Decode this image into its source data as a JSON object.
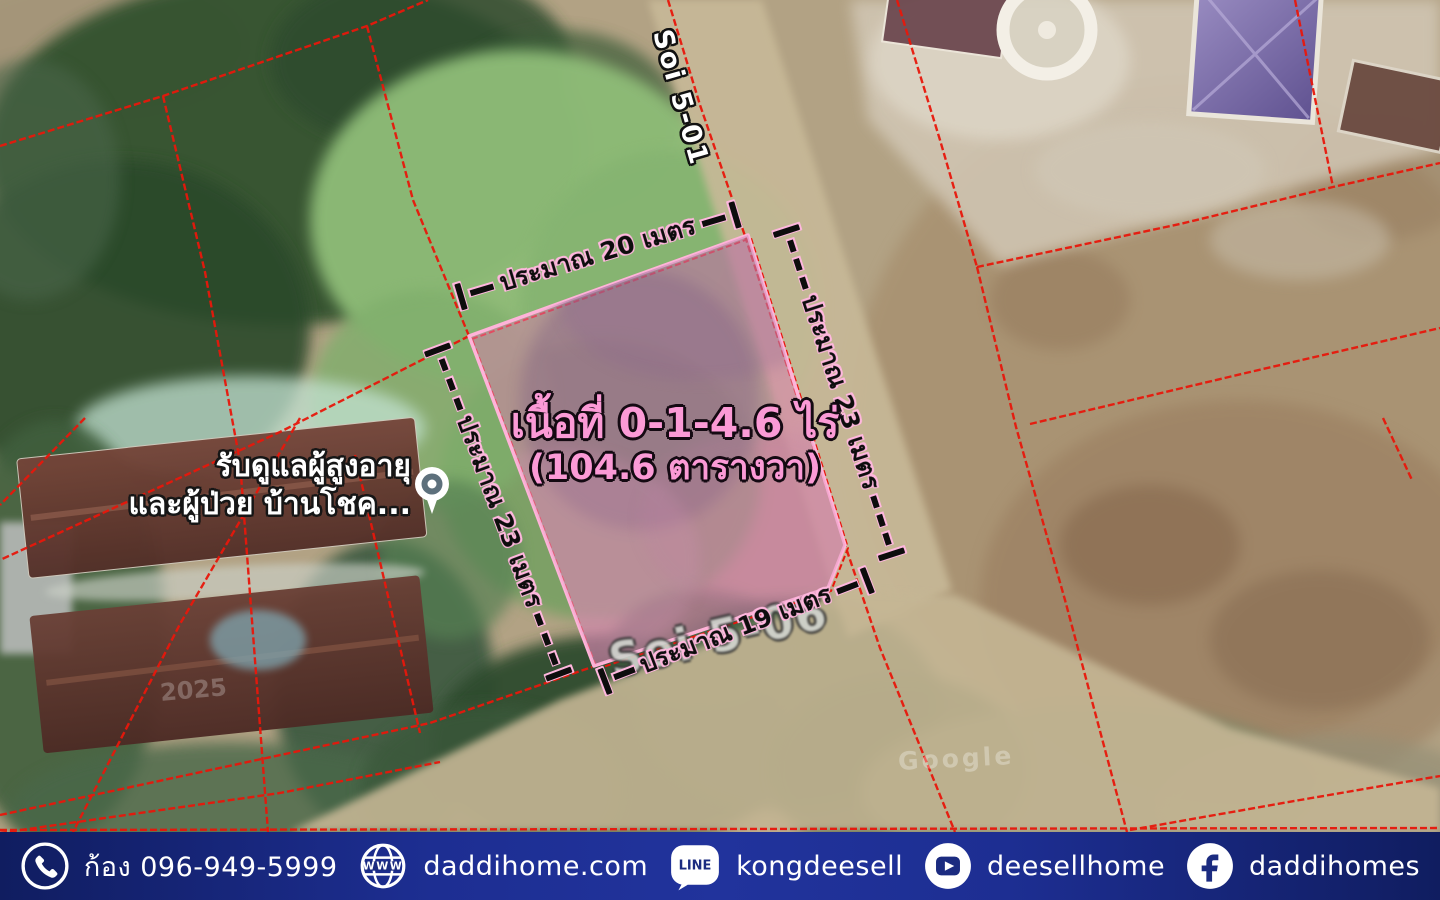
{
  "map": {
    "plot": {
      "area_line1": "เนื้อที่ 0-1-4.6 ไร่",
      "area_line2": "(104.6 ตารางวา)",
      "dimensions": {
        "top": "ประมาณ 20 เมตร",
        "right": "ประมาณ 23 เมตร",
        "left": "ประมาณ 23 เมตร",
        "bottom": "ประมาณ 19 เมตร"
      },
      "fill_color": "#dd7db0",
      "border_color": "#ffb3d9"
    },
    "street_labels": {
      "top": "Soi 5-01",
      "bottom": "Soi 5-06"
    },
    "place_label": {
      "line1": "รับดูแลผู้สูงอายุ",
      "line2": "และผู้ป่วย บ้านโชค..."
    },
    "watermarks": {
      "year": "2025",
      "brand": "Google"
    },
    "cadastral_line_color": "#e8170b"
  },
  "footer": {
    "background_color": "#1d2e92",
    "globe_text": "WWW",
    "line_badge_text": "LINE",
    "items": [
      {
        "icon": "phone-icon",
        "label": "ก้อง 096-949-5999"
      },
      {
        "icon": "globe-icon",
        "label": "daddihome.com"
      },
      {
        "icon": "line-icon",
        "label": "kongdeesell"
      },
      {
        "icon": "youtube-icon",
        "label": "deesellhome"
      },
      {
        "icon": "facebook-icon",
        "label": "daddihomes"
      }
    ]
  }
}
